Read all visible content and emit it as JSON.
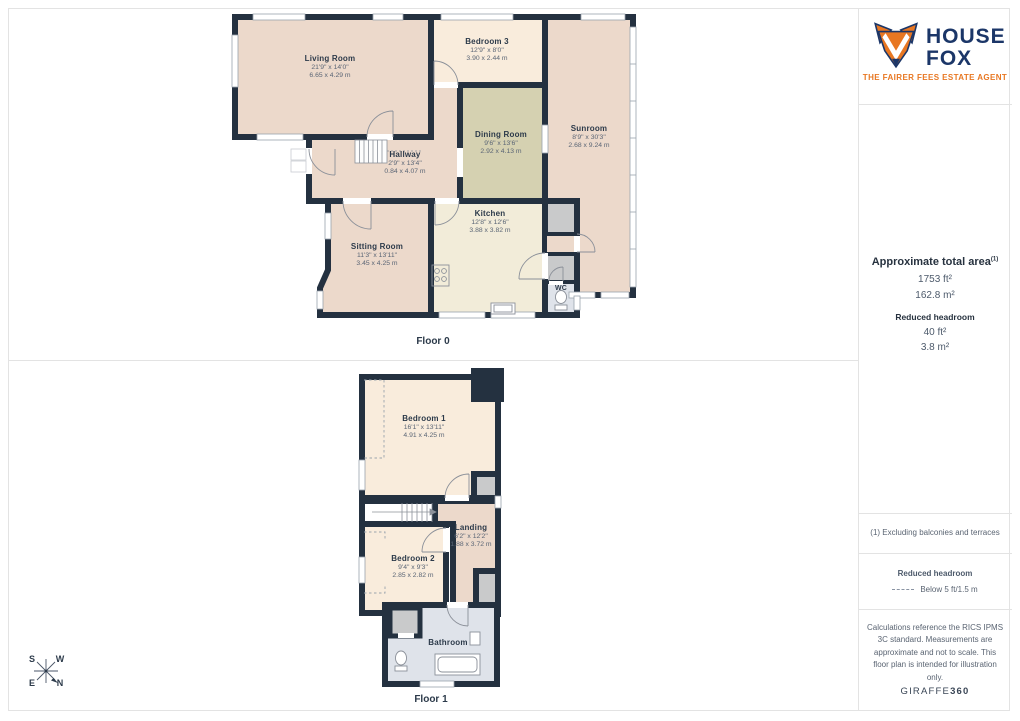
{
  "logo": {
    "line1": "HOUSE",
    "line2": "FOX",
    "tagline": "THE FAIRER FEES ESTATE AGENT"
  },
  "palette": {
    "wall": "#243140",
    "room_salmon": "#ecd9cb",
    "room_cream": "#f9ecdc",
    "room_olive": "#d5d1b1",
    "room_kitchen": "#f2ecd9",
    "room_bath": "#dfe3ea",
    "storage_gray": "#c9cacb",
    "brand_navy": "#1b3668",
    "brand_orange": "#e87722"
  },
  "sidebar": {
    "total_area_title": "Approximate total area",
    "total_area_note_ref": "(1)",
    "total_area_ft": "1753 ft²",
    "total_area_m": "162.8 m²",
    "reduced_title": "Reduced headroom",
    "reduced_ft": "40 ft²",
    "reduced_m": "3.8 m²",
    "footnote": "(1) Excluding balconies and terraces",
    "legend_title": "Reduced headroom",
    "legend_value": "Below 5 ft/1.5 m",
    "disclaimer": "Calculations reference the RICS IPMS 3C standard. Measurements are approximate and not to scale. This floor plan is intended for illustration only.",
    "credit_name": "GIRAFFE",
    "credit_number": "360"
  },
  "floor0": {
    "label": "Floor 0",
    "rooms": {
      "living_room": {
        "name": "Living Room",
        "imperial": "21'9\" x 14'0\"",
        "metric": "6.65 x 4.29 m"
      },
      "bedroom_3": {
        "name": "Bedroom 3",
        "imperial": "12'9\" x 8'0\"",
        "metric": "3.90 x 2.44 m"
      },
      "sunroom": {
        "name": "Sunroom",
        "imperial": "8'9\" x 30'3\"",
        "metric": "2.68 x 9.24 m"
      },
      "dining_room": {
        "name": "Dining Room",
        "imperial": "9'6\" x 13'6\"",
        "metric": "2.92 x 4.13 m"
      },
      "hallway": {
        "name": "Hallway",
        "imperial": "2'9\" x 13'4\"",
        "metric": "0.84 x 4.07 m"
      },
      "sitting_room": {
        "name": "Sitting Room",
        "imperial": "11'3\" x 13'11\"",
        "metric": "3.45 x 4.25 m"
      },
      "kitchen": {
        "name": "Kitchen",
        "imperial": "12'8\" x 12'6\"",
        "metric": "3.88 x 3.82 m"
      },
      "wc": {
        "name": "WC"
      }
    }
  },
  "floor1": {
    "label": "Floor 1",
    "rooms": {
      "bedroom_1": {
        "name": "Bedroom 1",
        "imperial": "16'1\" x 13'11\"",
        "metric": "4.91 x 4.25 m"
      },
      "landing": {
        "name": "Landing",
        "imperial": "6'2\" x 12'2\"",
        "metric": "1.88 x 3.72 m"
      },
      "bedroom_2": {
        "name": "Bedroom 2",
        "imperial": "9'4\" x 9'3\"",
        "metric": "2.85 x 2.82 m"
      },
      "bathroom": {
        "name": "Bathroom"
      }
    }
  },
  "compass": {
    "n": "N",
    "s": "S",
    "e": "E",
    "w": "W"
  }
}
